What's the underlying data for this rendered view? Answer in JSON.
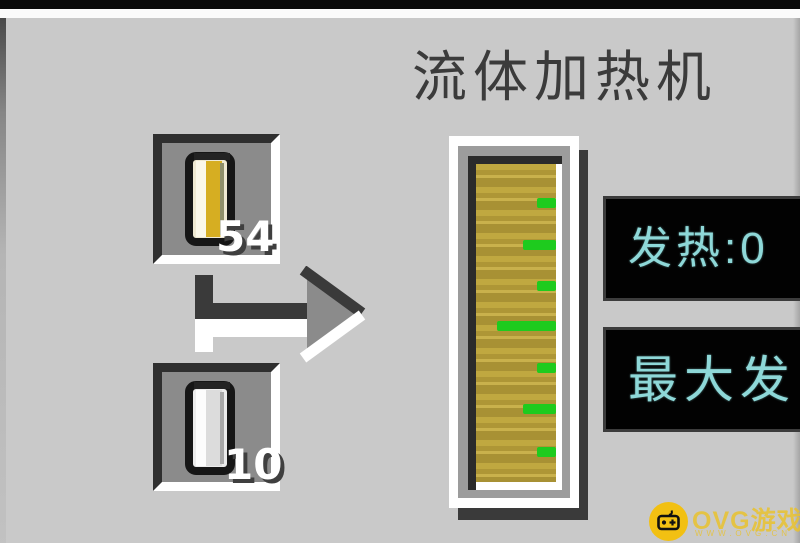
{
  "colors": {
    "background": "#c9c9c9",
    "slot_gray": "#8b8b8b",
    "bevel_dark": "#2f2f2f",
    "title_text": "#3b3b3b",
    "panel_text_cyan": "#8ed8d8",
    "gold_fill": "#b79f3a",
    "tick_green": "#1ecb1e",
    "watermark_yellow": "#f2c012"
  },
  "title": "流体加热机",
  "slots": {
    "input": {
      "item": "filled-cell",
      "count": "54"
    },
    "output": {
      "item": "empty-cell",
      "count": "10"
    }
  },
  "gauge": {
    "name": "heat-scale-tank",
    "ticks": [
      {
        "top": 34,
        "left": 61,
        "width": 19
      },
      {
        "top": 76,
        "left": 47,
        "width": 33
      },
      {
        "top": 117,
        "left": 61,
        "width": 19
      },
      {
        "top": 157,
        "left": 21,
        "width": 59
      },
      {
        "top": 199,
        "left": 61,
        "width": 19
      },
      {
        "top": 240,
        "left": 47,
        "width": 33
      },
      {
        "top": 283,
        "left": 61,
        "width": 19
      }
    ]
  },
  "panels": {
    "heat": {
      "label": "发热:0"
    },
    "max_heat": {
      "label": "最大发"
    }
  },
  "watermark": {
    "brand": "OVG游戏网",
    "url": "WWW.OVG.CN"
  }
}
